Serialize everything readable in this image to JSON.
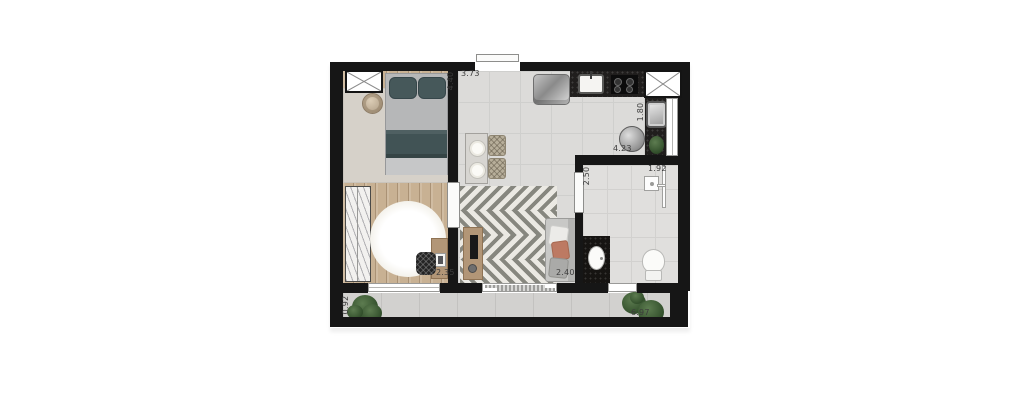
{
  "plan": {
    "type": "apartment-floor-plan",
    "dims": {
      "living_top": "3.73",
      "bedroom_left": "4.40",
      "service_side": "1.80",
      "living_bottomwall": "4.23",
      "bath_top": "1.92",
      "bath_side": "2.50",
      "bedroom_bottom": "2.35",
      "living_bottom": "2.40",
      "balcony_bottom": "6.97",
      "balcony_side": "0.92"
    },
    "colors": {
      "wall": "#161616",
      "wood_floor": "#c8b193",
      "tile_floor": "#dcdbd9",
      "balcony_floor": "#d2d1cf",
      "rug_beige": "#d6d1c9",
      "herringbone_dark": "#87877f",
      "herringbone_light": "#ebe9e3",
      "counter_black": "#201e1d",
      "bed_teal": "#46585a",
      "sofa_gray": "#c8c8c6",
      "accent_pillow_coral": "#bd7a63",
      "plant_green": "#33502c",
      "label_text": "#3c3c3c"
    }
  }
}
